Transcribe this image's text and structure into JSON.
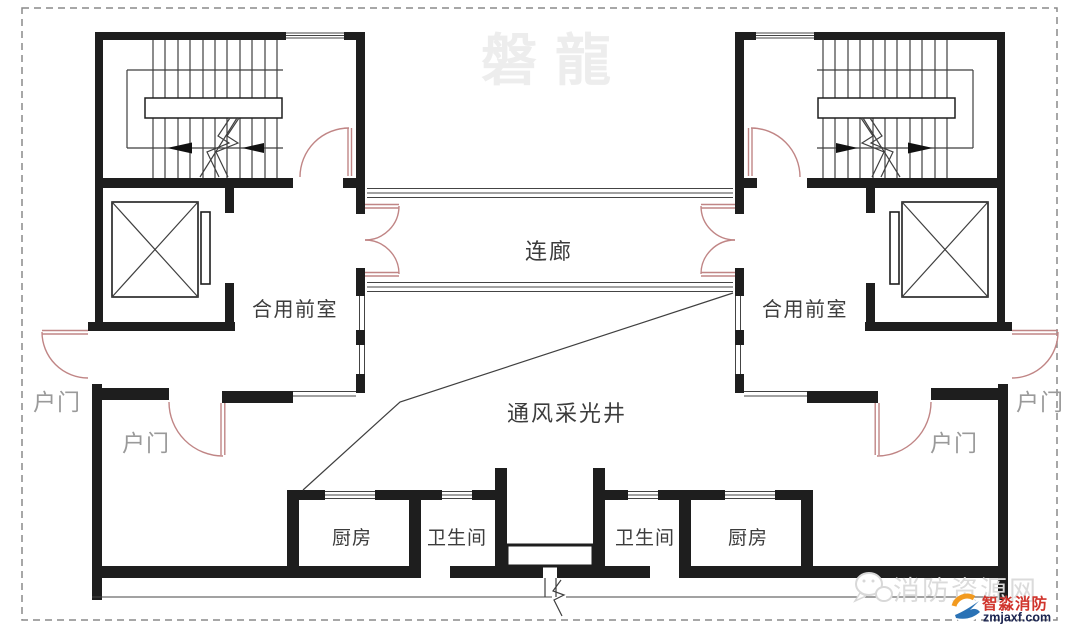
{
  "labels": {
    "corridor": "连廊",
    "front_room": "合用前室",
    "vent_shaft": "通风采光井",
    "entry_door": "户门",
    "kitchen": "厨房",
    "bathroom": "卫生间"
  },
  "watermark": {
    "brand": "磐龍",
    "site": "消防资源网"
  },
  "logo": {
    "name": "智淼消防",
    "url_text": "zmjaxf.com"
  },
  "colors": {
    "wall": "#1e1e1e",
    "thin_line": "#444444",
    "door_arc": "#c08585",
    "label_dark": "#3c3c3c",
    "label_gray": "#9a9a9a",
    "watermark_gray": "#ededed",
    "site_gray": "#dbdbdb",
    "logo_red": "#d0342c",
    "logo_navy": "#1b2450",
    "logo_orange": "#f29a1f",
    "logo_blue": "#2a72b5"
  }
}
